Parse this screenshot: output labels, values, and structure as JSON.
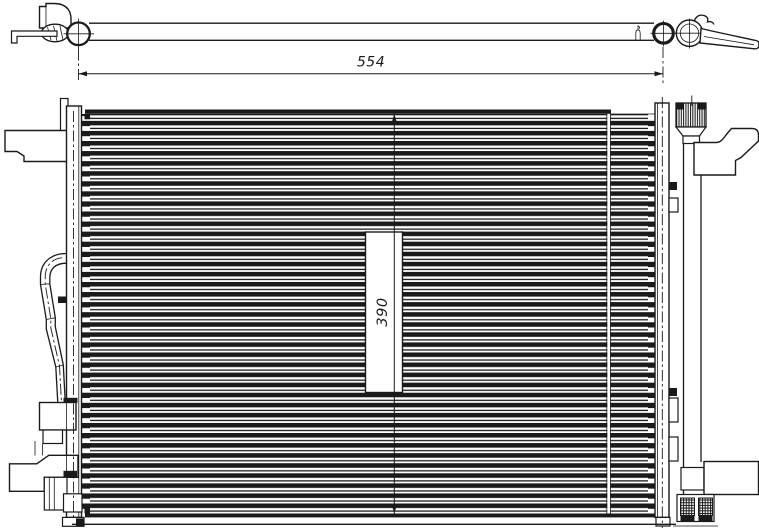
{
  "drawing": {
    "kind": "condenser-technical-drawing",
    "views": {
      "top_view": "condenser-top-profile-with-ports",
      "front_view": "condenser-core-with-receiver-drier"
    }
  },
  "dimensions": {
    "overall_width_label": "554",
    "core_height_label": "390"
  },
  "colors": {
    "line": "#1a1a1a",
    "background": "#ffffff"
  }
}
